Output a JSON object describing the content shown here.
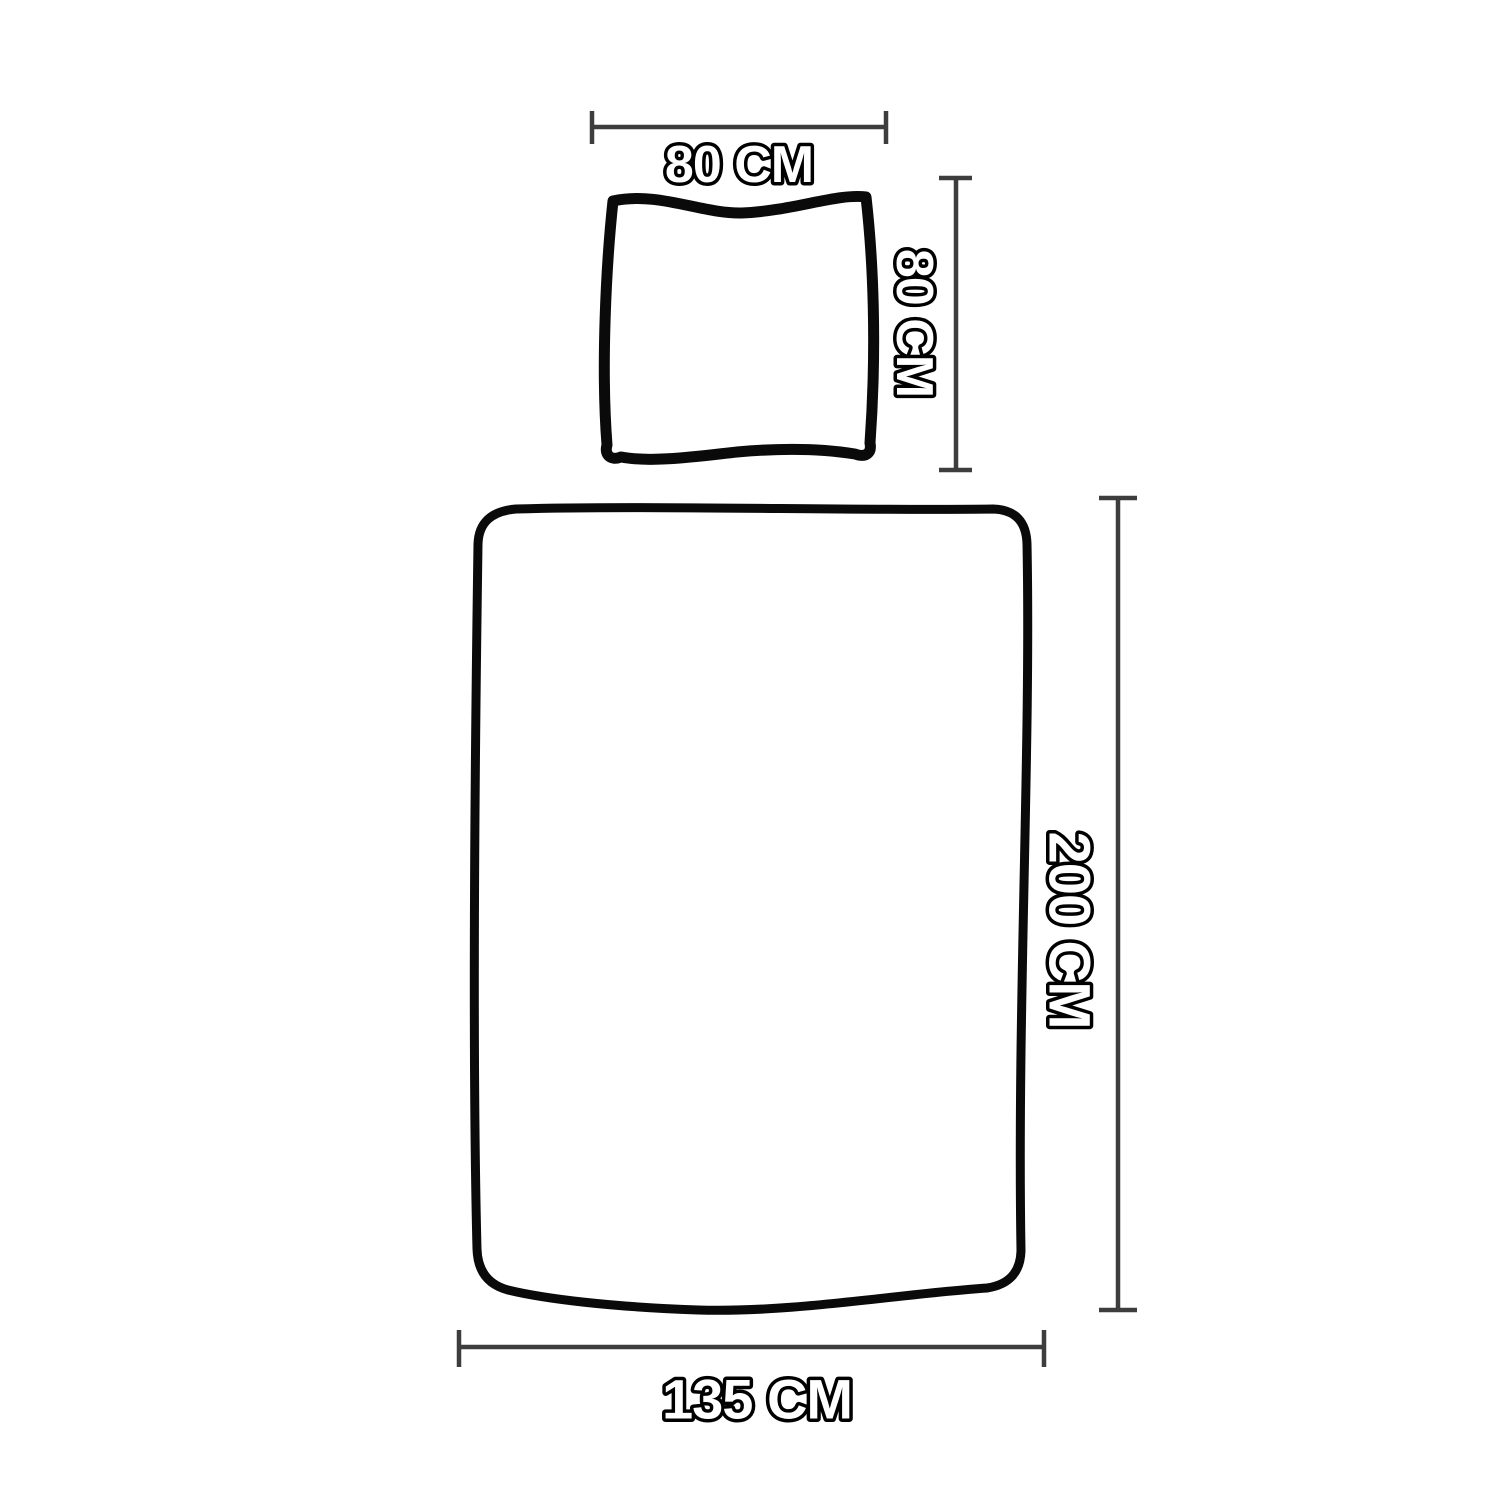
{
  "diagram": {
    "title": "bedding-size-diagram",
    "pillow": {
      "width_label": "80 CM",
      "height_label": "80 CM"
    },
    "duvet": {
      "height_label": "200 CM",
      "width_label": "135 CM"
    }
  },
  "colors": {
    "outline": "#0a0a0a",
    "dimline": "#3d3d3d",
    "textfill": "#ffffff",
    "textstroke": "#000000",
    "bg": "#ffffff"
  }
}
